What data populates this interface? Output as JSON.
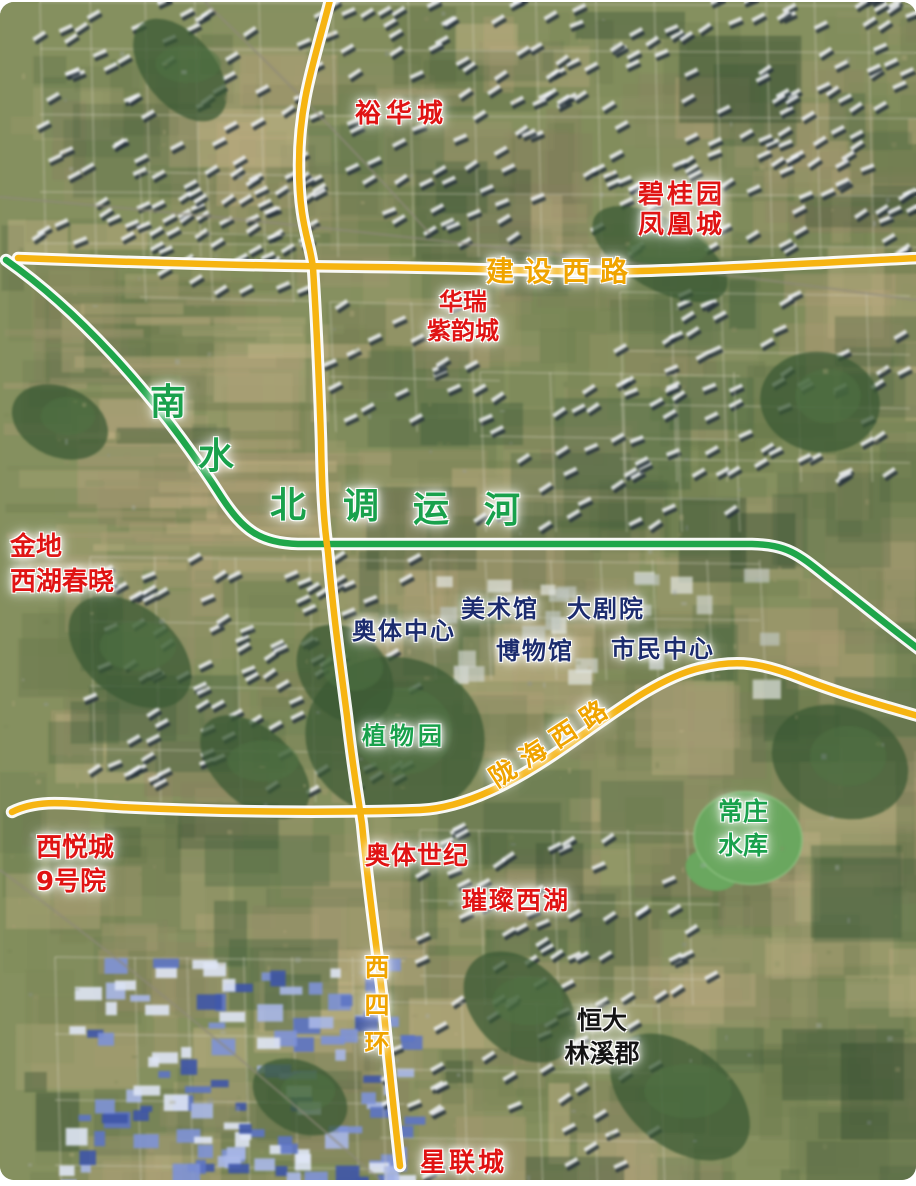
{
  "colors": {
    "road": "#f6b411",
    "canal": "#1fa64a",
    "red": "#e01313",
    "navy": "#1c2c6e",
    "green": "#19a14c",
    "gold": "#f0a400",
    "black": "#141414"
  },
  "road_labels": {
    "jianshexilu": "建设西路",
    "longhaixilu": "陇海西路",
    "xisihuan": "西四环"
  },
  "canal_label": {
    "full": "南水北调运河",
    "chars": [
      "南",
      "水",
      "北",
      "调",
      "运",
      "河"
    ]
  },
  "place_labels": {
    "yuhuacheng": "裕华城",
    "biguiyuan_fenghuangcheng": "碧桂园\n凤凰城",
    "huarui_ziyuncheng": "华瑞\n紫韵城",
    "jindi_xihuchunxiao": "金地\n西湖春晓",
    "aoti_zhongxin": "奥体中心",
    "meishuguan": "美术馆",
    "dajuyuan": "大剧院",
    "bowuguan": "博物馆",
    "shimin_zhongxin": "市民中心",
    "zhiwuyuan": "植物园",
    "changzhuang_shuiku": "常庄\n水库",
    "xiyuecheng_9haoyuan": "西悦城\n9号院",
    "aoti_shiji": "奥体世纪",
    "cuican_xihu": "璀璨西湖",
    "hengda_linxijun": "恒大\n林溪郡",
    "xinglian_cheng": "星联城"
  }
}
